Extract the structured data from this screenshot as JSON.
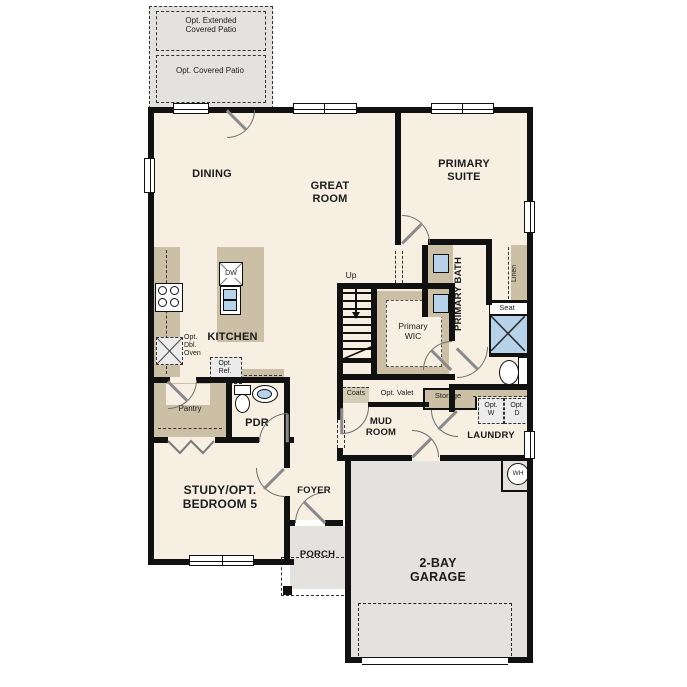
{
  "colors": {
    "wall": "#111111",
    "floor": "#f6efe2",
    "counter_tan": "#cbbfa5",
    "concrete_gray": "#e3e2df",
    "fixture_blue": "#b8d2ea",
    "door_swing": "#8a8a8a"
  },
  "labels": {
    "opt_extended_patio": "Opt. Extended Covered Patio",
    "opt_covered_patio": "Opt. Covered Patio",
    "dining": "DINING",
    "great_room": "GREAT ROOM",
    "primary_suite": "PRIMARY SUITE",
    "kitchen": "KITCHEN",
    "dw": "DW",
    "opt_dbl_oven": "Opt. Dbl. Oven",
    "opt_ref": "Opt. Ref.",
    "pantry": "Pantry",
    "pdr": "PDR",
    "study": "STUDY/OPT. BEDROOM 5",
    "foyer": "FOYER",
    "porch": "PORCH",
    "up": "Up",
    "primary_wic": "Primary WIC",
    "primary_bath": "PRIMARY BATH",
    "linen": "Linen",
    "seat": "Seat",
    "coats": "Coats",
    "opt_valet": "Opt. Valet",
    "storage": "Storage",
    "mud_room": "MUD ROOM",
    "laundry": "LAUNDRY",
    "opt_w": "Opt. W",
    "opt_d": "Opt. D",
    "garage": "2-BAY GARAGE",
    "wh": "WH"
  }
}
